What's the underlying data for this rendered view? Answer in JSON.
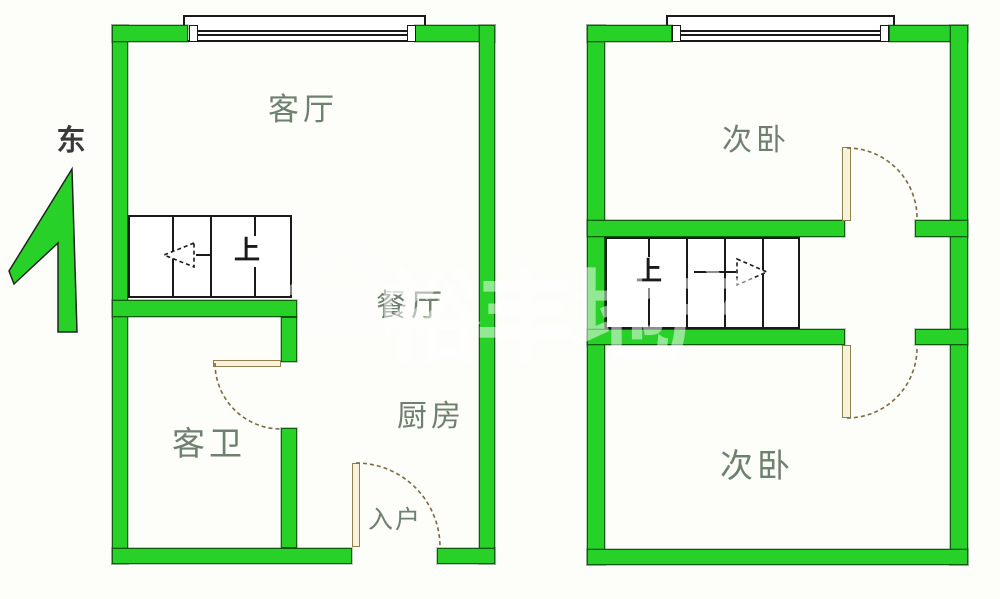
{
  "compass": {
    "label": "东"
  },
  "watermark": {
    "text": "裕丰地产",
    "icon": "house-outline-icon"
  },
  "floor_left": {
    "rooms": [
      {
        "id": "living-room",
        "label": "客厅"
      },
      {
        "id": "dining-room",
        "label": "餐厅"
      },
      {
        "id": "kitchen",
        "label": "厨房"
      },
      {
        "id": "guest-bathroom",
        "label": "客卫"
      },
      {
        "id": "entry",
        "label": "入户"
      }
    ],
    "stairs": {
      "label": "上",
      "arrow_direction": "left",
      "steps": 4
    }
  },
  "floor_right": {
    "rooms": [
      {
        "id": "bedroom-upper",
        "label": "次卧"
      },
      {
        "id": "bedroom-lower",
        "label": "次卧"
      }
    ],
    "stairs": {
      "label": "上",
      "arrow_direction": "right",
      "steps": 5
    }
  },
  "colors": {
    "wall": "#27d127",
    "wall-edge": "#0b5c0b",
    "line": "#1a1a1a",
    "door-fill": "#f8f2da",
    "door-edge": "#8f8050",
    "arc": "#7a6a45",
    "room-label": "#6e806e",
    "compass-label": "#3a3a3a",
    "bg": "#fdfdfa"
  }
}
